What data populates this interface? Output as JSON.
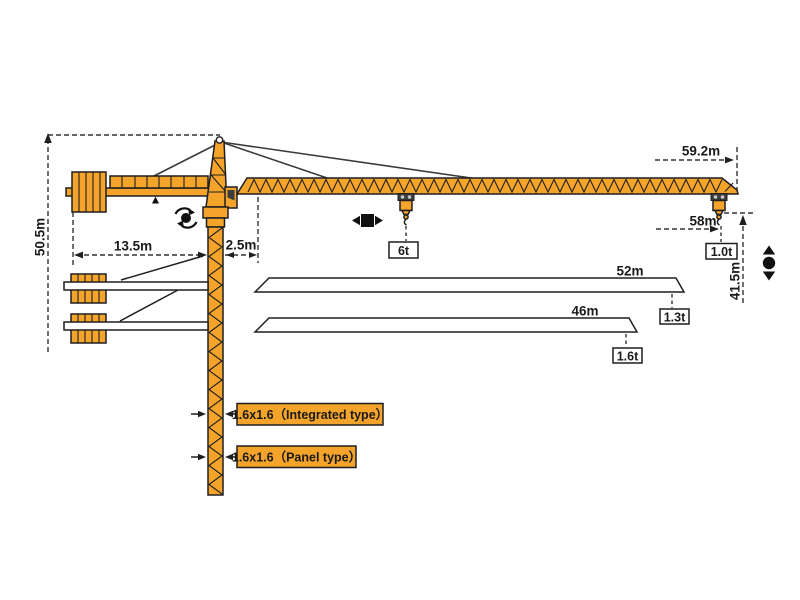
{
  "dimensions": {
    "total_height": "50.5m",
    "counterjib_length": "13.5m",
    "mast_to_pivot": "2.5m",
    "max_jib_radius": "59.2m",
    "hook_radius": "58m",
    "hook_height": "41.5m",
    "jib_option_1_length": "52m",
    "jib_option_2_length": "46m"
  },
  "loads": {
    "max_load": "6t",
    "tip_load_59m": "1.0t",
    "tip_load_52m": "1.3t",
    "tip_load_46m": "1.6t"
  },
  "mast_sections": {
    "integrated": "1.6x1.6（Integrated type）",
    "panel": "1.6x1.6（Panel type）"
  },
  "icons": {
    "slew": "slew-rotation-icon",
    "trolley": "trolley-travel-icon",
    "hook": "hook-travel-icon"
  },
  "colors": {
    "crane_orange": "#F5A42B",
    "outline": "#1F1F1F",
    "dim_line": "#333333",
    "background": "#FFFFFF"
  }
}
